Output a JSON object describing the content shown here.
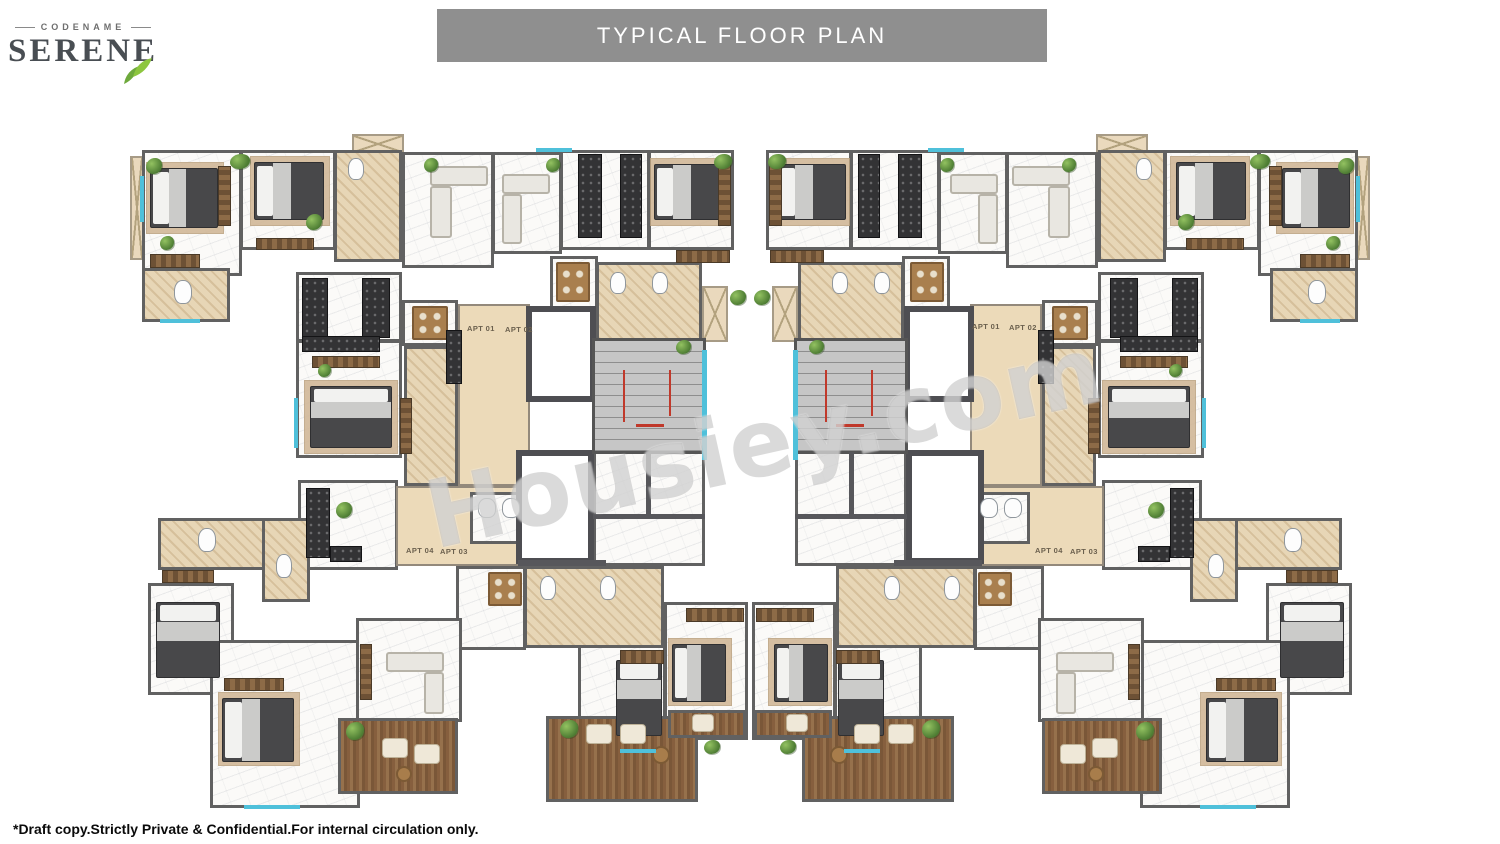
{
  "logo": {
    "codename": "CODENAME",
    "name": "SERENE"
  },
  "banner": {
    "title": "TYPICAL FLOOR PLAN"
  },
  "watermark": {
    "text": "Housiey.com"
  },
  "footer": {
    "note": "*Draft copy.Strictly Private & Confidential.For internal circulation only."
  },
  "colors": {
    "banner_bg": "#8f8f8f",
    "banner_text": "#ffffff",
    "wall": "#616161",
    "corridor": "#ecdab9",
    "bathroom": "#e7d6b6",
    "wood_balcony": "#865f3e",
    "stair_rail": "#c0392b",
    "window_accent": "#4fc0da",
    "leaf_green": "#7cb347",
    "logo_text": "#494e53",
    "watermark_gray": "#9e9e9e"
  },
  "plan": {
    "mirror_width": 1500,
    "labels": [
      {
        "text": "APT 01",
        "x": 467,
        "y": 324
      },
      {
        "text": "APT 02",
        "x": 505,
        "y": 325
      },
      {
        "text": "APT 04",
        "x": 406,
        "y": 546
      },
      {
        "text": "APT 03",
        "x": 440,
        "y": 547
      },
      {
        "text": "APT 01",
        "x": 972,
        "y": 322
      },
      {
        "text": "APT 02",
        "x": 1009,
        "y": 323
      },
      {
        "text": "APT 04",
        "x": 1035,
        "y": 546
      },
      {
        "text": "APT 03",
        "x": 1070,
        "y": 547
      }
    ],
    "elements": [
      {
        "t": "balcL",
        "x": 130,
        "y": 156,
        "w": 14,
        "h": 104
      },
      {
        "t": "balcL",
        "x": 352,
        "y": 134,
        "w": 52,
        "h": 20
      },
      {
        "t": "balcL",
        "x": 634,
        "y": 306,
        "w": 40,
        "h": 32
      },
      {
        "t": "balcL",
        "x": 702,
        "y": 286,
        "w": 26,
        "h": 56
      },
      {
        "t": "balcL",
        "x": 237,
        "y": 540,
        "w": 30,
        "h": 22
      },
      {
        "t": "room",
        "x": 142,
        "y": 150,
        "w": 100,
        "h": 126
      },
      {
        "t": "room",
        "x": 240,
        "y": 150,
        "w": 96,
        "h": 100
      },
      {
        "t": "room",
        "x": 402,
        "y": 152,
        "w": 92,
        "h": 116
      },
      {
        "t": "room",
        "x": 492,
        "y": 152,
        "w": 70,
        "h": 102
      },
      {
        "t": "room",
        "x": 560,
        "y": 150,
        "w": 90,
        "h": 100
      },
      {
        "t": "room",
        "x": 648,
        "y": 150,
        "w": 86,
        "h": 100
      },
      {
        "t": "room",
        "x": 296,
        "y": 272,
        "w": 106,
        "h": 70
      },
      {
        "t": "room",
        "x": 296,
        "y": 340,
        "w": 106,
        "h": 118
      },
      {
        "t": "room",
        "x": 298,
        "y": 480,
        "w": 100,
        "h": 90
      },
      {
        "t": "room",
        "x": 550,
        "y": 256,
        "w": 48,
        "h": 54
      },
      {
        "t": "room",
        "x": 402,
        "y": 300,
        "w": 56,
        "h": 46
      },
      {
        "t": "room",
        "x": 456,
        "y": 566,
        "w": 70,
        "h": 84
      },
      {
        "t": "room",
        "x": 148,
        "y": 583,
        "w": 86,
        "h": 112
      },
      {
        "t": "room",
        "x": 210,
        "y": 640,
        "w": 150,
        "h": 168
      },
      {
        "t": "room",
        "x": 356,
        "y": 618,
        "w": 106,
        "h": 104
      },
      {
        "t": "room",
        "x": 578,
        "y": 640,
        "w": 88,
        "h": 112
      },
      {
        "t": "room",
        "x": 664,
        "y": 602,
        "w": 84,
        "h": 138
      },
      {
        "t": "room",
        "x": 593,
        "y": 450,
        "w": 112,
        "h": 116
      },
      {
        "t": "bath",
        "x": 142,
        "y": 268,
        "w": 88,
        "h": 54
      },
      {
        "t": "bath",
        "x": 334,
        "y": 150,
        "w": 68,
        "h": 112
      },
      {
        "t": "bath",
        "x": 596,
        "y": 262,
        "w": 106,
        "h": 80
      },
      {
        "t": "bath",
        "x": 404,
        "y": 346,
        "w": 54,
        "h": 140
      },
      {
        "t": "bath",
        "x": 158,
        "y": 518,
        "w": 152,
        "h": 52
      },
      {
        "t": "bath",
        "x": 262,
        "y": 518,
        "w": 48,
        "h": 84
      },
      {
        "t": "bath",
        "x": 524,
        "y": 566,
        "w": 140,
        "h": 82
      },
      {
        "t": "cor",
        "x": 458,
        "y": 304,
        "w": 72,
        "h": 182
      },
      {
        "t": "cor",
        "x": 396,
        "y": 486,
        "w": 130,
        "h": 80
      },
      {
        "t": "room",
        "x": 470,
        "y": 492,
        "w": 62,
        "h": 52
      },
      {
        "t": "lift",
        "x": 526,
        "y": 306,
        "w": 70,
        "h": 96
      },
      {
        "t": "lift",
        "x": 516,
        "y": 450,
        "w": 78,
        "h": 114
      },
      {
        "t": "stairs",
        "x": 592,
        "y": 338,
        "w": 114,
        "h": 116
      },
      {
        "t": "railh",
        "x": 636,
        "y": 424,
        "w": 28,
        "h": 3
      },
      {
        "t": "wallh",
        "x": 593,
        "y": 514,
        "w": 112,
        "h": 5
      },
      {
        "t": "wallv",
        "x": 646,
        "y": 452,
        "w": 5,
        "h": 64
      },
      {
        "t": "wallh",
        "x": 518,
        "y": 560,
        "w": 88,
        "h": 6
      },
      {
        "t": "balc",
        "x": 338,
        "y": 718,
        "w": 120,
        "h": 76
      },
      {
        "t": "balc",
        "x": 546,
        "y": 716,
        "w": 152,
        "h": 86
      },
      {
        "t": "balc",
        "x": 668,
        "y": 710,
        "w": 78,
        "h": 28
      },
      {
        "t": "rug",
        "x": 146,
        "y": 162,
        "w": 78,
        "h": 72
      },
      {
        "t": "rug",
        "x": 250,
        "y": 156,
        "w": 80,
        "h": 70
      },
      {
        "t": "rug",
        "x": 650,
        "y": 158,
        "w": 80,
        "h": 68
      },
      {
        "t": "rug",
        "x": 304,
        "y": 380,
        "w": 94,
        "h": 74
      },
      {
        "t": "rug",
        "x": 218,
        "y": 692,
        "w": 82,
        "h": 74
      },
      {
        "t": "rug",
        "x": 668,
        "y": 638,
        "w": 64,
        "h": 68
      },
      {
        "t": "bed",
        "x": 150,
        "y": 168,
        "w": 68,
        "h": 60
      },
      {
        "t": "bed",
        "x": 254,
        "y": 162,
        "w": 70,
        "h": 58
      },
      {
        "t": "bed",
        "x": 654,
        "y": 164,
        "w": 70,
        "h": 56
      },
      {
        "t": "bed",
        "x": 310,
        "y": 386,
        "w": 82,
        "h": 62,
        "v": 1
      },
      {
        "t": "bed",
        "x": 156,
        "y": 602,
        "w": 64,
        "h": 76,
        "v": 1
      },
      {
        "t": "bed",
        "x": 222,
        "y": 698,
        "w": 72,
        "h": 64
      },
      {
        "t": "bed",
        "x": 616,
        "y": 660,
        "w": 46,
        "h": 76,
        "v": 1
      },
      {
        "t": "bed",
        "x": 672,
        "y": 644,
        "w": 54,
        "h": 58
      },
      {
        "t": "ward",
        "x": 150,
        "y": 254,
        "w": 50,
        "h": 14
      },
      {
        "t": "ward",
        "x": 256,
        "y": 238,
        "w": 58,
        "h": 12
      },
      {
        "t": "ward",
        "x": 676,
        "y": 250,
        "w": 54,
        "h": 13
      },
      {
        "t": "ward",
        "x": 224,
        "y": 678,
        "w": 60,
        "h": 13
      },
      {
        "t": "ward",
        "x": 620,
        "y": 650,
        "w": 44,
        "h": 14
      },
      {
        "t": "ward",
        "x": 686,
        "y": 608,
        "w": 58,
        "h": 14
      },
      {
        "t": "ward",
        "x": 162,
        "y": 570,
        "w": 52,
        "h": 13
      },
      {
        "t": "ward",
        "x": 312,
        "y": 356,
        "w": 68,
        "h": 12
      },
      {
        "t": "ward",
        "x": 218,
        "y": 166,
        "w": 13,
        "h": 60,
        "v": 1
      },
      {
        "t": "ward",
        "x": 718,
        "y": 164,
        "w": 13,
        "h": 62,
        "v": 1
      },
      {
        "t": "ward",
        "x": 400,
        "y": 398,
        "w": 12,
        "h": 56,
        "v": 1
      },
      {
        "t": "ward",
        "x": 360,
        "y": 644,
        "w": 12,
        "h": 56,
        "v": 1
      },
      {
        "t": "sofa",
        "x": 430,
        "y": 166,
        "w": 58,
        "h": 20
      },
      {
        "t": "sofa",
        "x": 430,
        "y": 186,
        "w": 22,
        "h": 52
      },
      {
        "t": "sofa",
        "x": 502,
        "y": 174,
        "w": 48,
        "h": 20
      },
      {
        "t": "sofa",
        "x": 502,
        "y": 194,
        "w": 20,
        "h": 50
      },
      {
        "t": "sofa",
        "x": 386,
        "y": 652,
        "w": 58,
        "h": 20
      },
      {
        "t": "sofa",
        "x": 424,
        "y": 672,
        "w": 20,
        "h": 42
      },
      {
        "t": "table",
        "x": 412,
        "y": 306,
        "w": 36,
        "h": 34
      },
      {
        "t": "table",
        "x": 556,
        "y": 262,
        "w": 34,
        "h": 40
      },
      {
        "t": "table",
        "x": 488,
        "y": 572,
        "w": 34,
        "h": 34
      },
      {
        "t": "chair",
        "x": 586,
        "y": 724,
        "w": 26,
        "h": 20
      },
      {
        "t": "chair",
        "x": 620,
        "y": 724,
        "w": 26,
        "h": 20
      },
      {
        "t": "tableR",
        "x": 652,
        "y": 746,
        "w": 18,
        "h": 18
      },
      {
        "t": "chair",
        "x": 692,
        "y": 714,
        "w": 22,
        "h": 18
      },
      {
        "t": "chair",
        "x": 382,
        "y": 738,
        "w": 26,
        "h": 20
      },
      {
        "t": "chair",
        "x": 414,
        "y": 744,
        "w": 26,
        "h": 20
      },
      {
        "t": "tableR",
        "x": 396,
        "y": 766,
        "w": 16,
        "h": 16
      },
      {
        "t": "counter",
        "x": 578,
        "y": 154,
        "w": 24,
        "h": 84,
        "v": 1
      },
      {
        "t": "counter",
        "x": 620,
        "y": 154,
        "w": 22,
        "h": 84,
        "v": 1
      },
      {
        "t": "counter",
        "x": 302,
        "y": 278,
        "w": 26,
        "h": 60,
        "v": 1
      },
      {
        "t": "counter",
        "x": 362,
        "y": 278,
        "w": 28,
        "h": 60,
        "v": 1
      },
      {
        "t": "counter",
        "x": 302,
        "y": 336,
        "w": 78,
        "h": 16
      },
      {
        "t": "counter",
        "x": 306,
        "y": 488,
        "w": 24,
        "h": 70,
        "v": 1
      },
      {
        "t": "counter",
        "x": 330,
        "y": 546,
        "w": 32,
        "h": 16
      },
      {
        "t": "counter",
        "x": 446,
        "y": 330,
        "w": 16,
        "h": 54,
        "v": 1
      },
      {
        "t": "fix",
        "x": 174,
        "y": 280,
        "w": 18,
        "h": 24
      },
      {
        "t": "fix",
        "x": 348,
        "y": 158,
        "w": 16,
        "h": 22
      },
      {
        "t": "fix",
        "x": 610,
        "y": 272,
        "w": 16,
        "h": 22
      },
      {
        "t": "fix",
        "x": 652,
        "y": 272,
        "w": 16,
        "h": 22
      },
      {
        "t": "fix",
        "x": 198,
        "y": 528,
        "w": 18,
        "h": 24
      },
      {
        "t": "fix",
        "x": 276,
        "y": 554,
        "w": 16,
        "h": 24
      },
      {
        "t": "fix",
        "x": 540,
        "y": 576,
        "w": 16,
        "h": 24
      },
      {
        "t": "fix",
        "x": 600,
        "y": 576,
        "w": 16,
        "h": 24
      },
      {
        "t": "fix",
        "x": 478,
        "y": 498,
        "w": 18,
        "h": 20
      },
      {
        "t": "fix",
        "x": 502,
        "y": 498,
        "w": 18,
        "h": 20
      },
      {
        "t": "plant",
        "x": 146,
        "y": 158,
        "w": 16,
        "h": 16
      },
      {
        "t": "plant",
        "x": 230,
        "y": 154,
        "w": 20,
        "h": 15
      },
      {
        "t": "plant",
        "x": 424,
        "y": 158,
        "w": 14,
        "h": 14
      },
      {
        "t": "plant",
        "x": 546,
        "y": 158,
        "w": 14,
        "h": 14
      },
      {
        "t": "plant",
        "x": 714,
        "y": 154,
        "w": 18,
        "h": 15
      },
      {
        "t": "plant",
        "x": 306,
        "y": 214,
        "w": 16,
        "h": 16
      },
      {
        "t": "plant",
        "x": 318,
        "y": 364,
        "w": 13,
        "h": 13
      },
      {
        "t": "plant",
        "x": 336,
        "y": 502,
        "w": 16,
        "h": 16
      },
      {
        "t": "plant",
        "x": 346,
        "y": 722,
        "w": 18,
        "h": 18
      },
      {
        "t": "plant",
        "x": 560,
        "y": 720,
        "w": 18,
        "h": 18
      },
      {
        "t": "plant",
        "x": 676,
        "y": 340,
        "w": 15,
        "h": 14
      },
      {
        "t": "plant",
        "x": 730,
        "y": 290,
        "w": 16,
        "h": 15
      },
      {
        "t": "plant",
        "x": 704,
        "y": 740,
        "w": 16,
        "h": 14
      },
      {
        "t": "plant",
        "x": 160,
        "y": 236,
        "w": 14,
        "h": 14
      },
      {
        "t": "win",
        "x": 140,
        "y": 176,
        "w": 4,
        "h": 46
      },
      {
        "t": "win",
        "x": 702,
        "y": 350,
        "w": 5,
        "h": 110
      },
      {
        "t": "win",
        "x": 294,
        "y": 398,
        "w": 4,
        "h": 50
      },
      {
        "t": "win",
        "x": 536,
        "y": 148,
        "w": 36,
        "h": 4
      },
      {
        "t": "win",
        "x": 160,
        "y": 319,
        "w": 40,
        "h": 4
      },
      {
        "t": "win",
        "x": 244,
        "y": 805,
        "w": 56,
        "h": 4
      },
      {
        "t": "win",
        "x": 620,
        "y": 749,
        "w": 36,
        "h": 4
      }
    ]
  }
}
